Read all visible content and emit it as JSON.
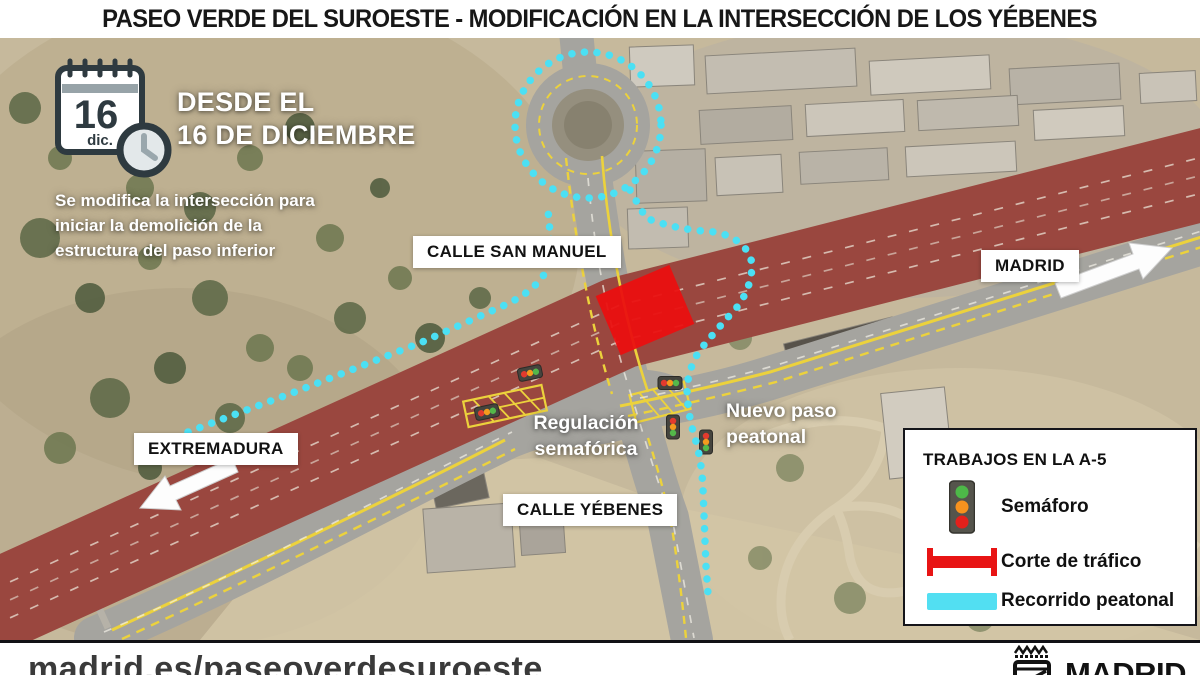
{
  "header": {
    "title": "PASEO VERDE DEL SUROESTE - MODIFICACIÓN EN LA INTERSECCIÓN DE LOS YÉBENES"
  },
  "callout": {
    "calendar_day": "16",
    "calendar_month": "dic.",
    "heading_line1": "DESDE EL",
    "heading_line2": "16 DE DICIEMBRE",
    "description": "Se modifica la intersección para iniciar la demolición de la estructura del paso inferior"
  },
  "map_labels": {
    "calle_san_manuel": "CALLE SAN MANUEL",
    "calle_yebenes": "CALLE YÉBENES",
    "direction_madrid": "MADRID",
    "direction_extremadura": "EXTREMADURA",
    "regulacion_semaforica": "Regulación semafórica",
    "nuevo_paso_peatonal": "Nuevo paso peatonal"
  },
  "legend": {
    "title": "TRABAJOS EN LA A-5",
    "items": [
      {
        "icon": "traffic-light-icon",
        "label": "Semáforo"
      },
      {
        "icon": "road-closure-icon",
        "label": "Corte de tráfico",
        "color": "#e81414"
      },
      {
        "icon": "pedestrian-route-icon",
        "label": "Recorrido peatonal",
        "color": "#52dff2"
      }
    ]
  },
  "footer": {
    "url": "madrid.es/paseoverdesuroeste",
    "logo_text": "MADRID"
  },
  "colors": {
    "closure_red": "#e81414",
    "pedestrian_cyan": "#52dff2",
    "highway_red": "#9a473f",
    "road_marking_yellow": "#ecd23c"
  }
}
